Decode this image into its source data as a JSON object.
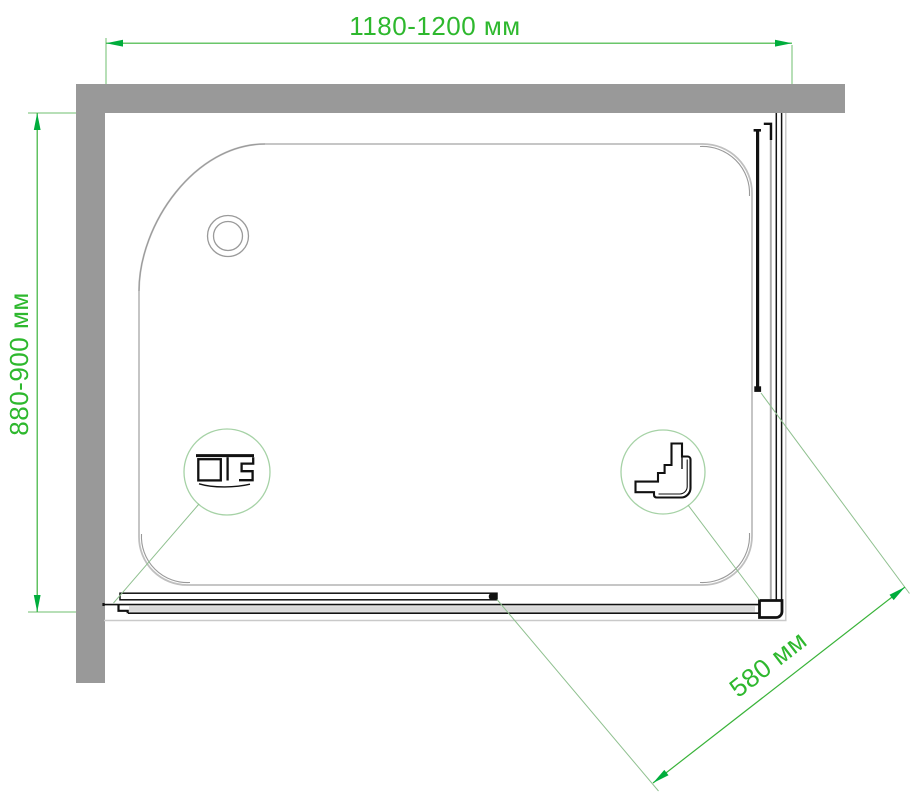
{
  "diagram": {
    "type": "shower-enclosure-top-view-drawing",
    "dimensions": {
      "width_label": "1180-1200 мм",
      "depth_label": "880-900 мм",
      "entry_label": "580 мм"
    },
    "icons": {
      "detail_left": "wall-profile-section",
      "detail_right": "corner-connector-section",
      "drain": "drain-hole"
    },
    "colors": {
      "dimension_text": "#2eb82e",
      "dimension_line": "#39b339",
      "arrow": "#00ad3c",
      "extension_line": "#6fbf6f",
      "leader_line": "#8fc08f",
      "detail_circle": "#a6d2a6",
      "wall": "#999999",
      "tray_outline": "#bfbfbf",
      "tray_accent": "#9a9a9a",
      "profile": "#111111",
      "rail_fill": "#d9d9d9"
    }
  }
}
